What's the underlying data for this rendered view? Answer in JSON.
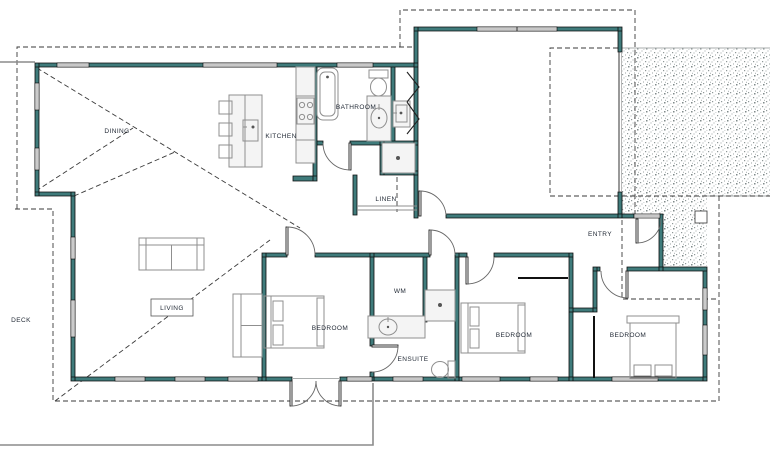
{
  "title": "House floor plan",
  "colors": {
    "wall": "#3f7b7b",
    "wall_edge": "#0d0d0d",
    "dashed_line": "#3a3a3a",
    "furniture_stroke": "#8f8f8f",
    "furniture_fill": "#f4f4f4",
    "stipple": "#8f9898",
    "label_text": "#1f2733",
    "boundary_gray": "#8c8c8c"
  },
  "labels": {
    "dining": "DINING",
    "kitchen": "KITCHEN",
    "bathroom": "BATHROOM",
    "linen": "LINEN",
    "entry": "ENTRY",
    "living": "LIVING",
    "deck": "DECK",
    "bedroom1": "BEDROOM",
    "bedroom2": "BEDROOM",
    "bedroom3": "BEDROOM",
    "ensuite": "ENSUITE",
    "wm": "WM"
  }
}
